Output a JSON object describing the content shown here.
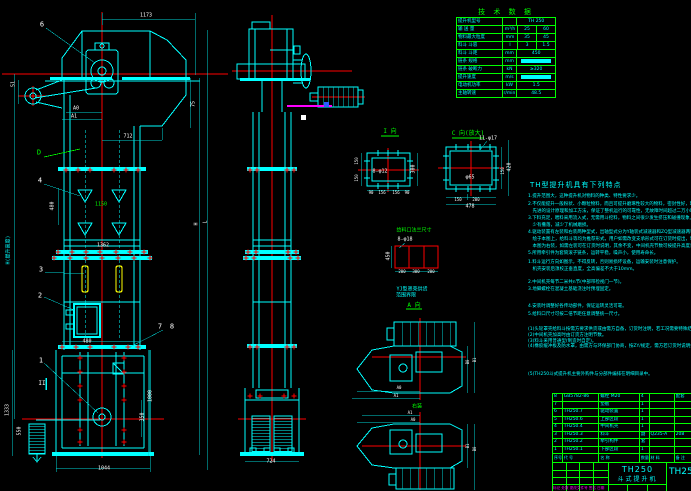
{
  "app": {
    "type": "cad-drawing",
    "background": "#000000"
  },
  "colors": {
    "geometry": "#00ffff",
    "centerline": "#ff0000",
    "table": "#00ff00",
    "dim_text": "#ffffff",
    "bucket": "#ffff00",
    "highlight": "#ff00ff",
    "grip": "#ffffff"
  },
  "tech_table": {
    "title": "技 术 数 据",
    "rows": [
      {
        "label": "提升机型号",
        "unit": "",
        "v1": "TH 250",
        "span": true
      },
      {
        "label": "输 送 量",
        "unit": "m³/h",
        "v1": "25",
        "v2": "60"
      },
      {
        "label": "物料最大粒度",
        "unit": "mm",
        "v1": "35",
        "v2": "45"
      },
      {
        "label": "料斗 斗容",
        "unit": "l",
        "v1": "3",
        "v2": "1.5"
      },
      {
        "label": "料斗 斗距",
        "unit": "mm",
        "v1": "450",
        "span": true
      },
      {
        "label": "链条 规格",
        "unit": "mm",
        "v1": "",
        "span": true,
        "filled": true
      },
      {
        "label": "链条 破断力",
        "unit": "kN",
        "v1": "≥320",
        "span": true
      },
      {
        "label": "提升速度",
        "unit": "m/s",
        "v1": "",
        "span": true,
        "filled": true
      },
      {
        "label": "电动机功率",
        "unit": "kW",
        "v1": "1.5",
        "span": true
      },
      {
        "label": "主轴转速",
        "unit": "r/min",
        "v1": "48.5",
        "span": true
      }
    ]
  },
  "notes": {
    "title": "TH型提升机具有下列特点",
    "lines": [
      {
        "y": 195,
        "t": "1.提升范围大，这种提升机对物料的种类、特性要求少。"
      },
      {
        "y": 203,
        "t": "2.不仅能提升一般粉状、小颗粒物料，而且可提升磨琢性较大的物料，密封性好，环境污染少，运行可靠性高，使用寿命长。"
      },
      {
        "y": 210,
        "t": "　先进的设计原理和加工方法，保证了整机运行的可靠性，无故障时间超过二万小时。"
      },
      {
        "y": 217,
        "t": "3.下料充足，喂料采用流入式，无需用斗挖料，物料之间很少发生挤压和碰撞现象，本机设计时保证物料在喂料、卸料时"
      },
      {
        "y": 224,
        "t": "　少有撒落，减少了机械磨损。"
      },
      {
        "y": 231,
        "t": "4.驱动装置有左装和右装两种型式，出轴型式分为Y轴装式减速器和ZQ型减速器两种，机上的驱动平台、栏杆、支架等均"
      },
      {
        "y": 238,
        "t": "　绘于本图上，给料斗等均为推荐形式，用户如需改变支承形式可在订货时提出，制造部门应满足用户要求。"
      },
      {
        "y": 245,
        "t": "　本图为右装，如需左装可在订货时说明，其余不变，中间机壳节数可按提升高度调整。"
      },
      {
        "y": 252,
        "t": "5.所用牵引件为套筒滚子链条，运转平稳，噪声小，使用寿命长。"
      },
      {
        "y": 261,
        "t": "1.料斗运行方向如图示，不得反转，否则易损坏设备，运输安装时注意保护。"
      },
      {
        "y": 268,
        "t": "　机壳安装后须校正垂直度，全高偏差不大于10mm。"
      },
      {
        "y": 281,
        "t": "2.中间机壳每节二米共n节(中部带检视门一节)。"
      },
      {
        "y": 288,
        "t": "3.地脚螺栓在混凝土基础浇注时预埋固定。"
      },
      {
        "y": 305,
        "t": "4.安装时调整好各传动部件，保证运转灵活可靠。"
      },
      {
        "y": 313,
        "t": "5.给料口尺寸可按二倍节距任意调整统一尺寸。"
      },
      {
        "y": 328,
        "t": "(1)头轮罩壳给料斗按需方要求供货或由需方自备，订货时注明，若工况需要特殊结构，由供需双方协商另行设计。"
      },
      {
        "y": 334,
        "t": "(2)中间机壳加高时由订货方注明节数。"
      },
      {
        "y": 340,
        "t": "(3)料斗采用普通型(制造时自定)。"
      },
      {
        "y": 345,
        "t": "(4)橡胶缓冲板及防水罩，由需方与环保部门协商，按ZY/规定，需方若订货时说明按协议生产供货。"
      },
      {
        "y": 373,
        "t": "(5)TH250斗式提升机主要外购件与分部件编排在明细目录中。"
      }
    ]
  },
  "bom": {
    "header": [
      "序号",
      "代  号",
      "名  称",
      "数量",
      "材  料",
      "备 注"
    ],
    "rows": [
      [
        "8",
        "GB5782-86",
        "螺栓 M20",
        "4",
        "",
        "配套"
      ],
      [
        "7",
        "",
        "垫板",
        "1",
        "",
        ""
      ],
      [
        "6",
        "TH250.7",
        "驱动装置",
        "1",
        "",
        ""
      ],
      [
        "5",
        "TH250.6",
        "上部区段",
        "1",
        "",
        ""
      ],
      [
        "4",
        "TH250.4",
        "中间机壳",
        "1",
        "",
        ""
      ],
      [
        "3",
        "TH250.3",
        "料斗",
        "副",
        "Q235-A",
        "208"
      ],
      [
        "2",
        "TH250.2",
        "牵引构件",
        "套",
        "",
        ""
      ],
      [
        "1",
        "TH250.1",
        "下部区段",
        "1",
        "",
        ""
      ]
    ]
  },
  "title_block": {
    "model": "TH250",
    "name": "斗式提升机",
    "drawing_no": "TH250",
    "revision_note": "标记 处数 更改文件号 签名 日期"
  },
  "labels": [
    {
      "t": "1173",
      "x": 146,
      "y": 16
    },
    {
      "t": "6",
      "x": 42,
      "y": 25,
      "s": 7,
      "n": "balloon-6"
    },
    {
      "t": "51",
      "x": 14,
      "y": 84,
      "r": 1
    },
    {
      "t": "75",
      "x": 194,
      "y": 104,
      "r": 1
    },
    {
      "t": "A0",
      "x": 76,
      "y": 109
    },
    {
      "t": "A1",
      "x": 74,
      "y": 117
    },
    {
      "t": "712",
      "x": 128,
      "y": 137
    },
    {
      "t": "D",
      "x": 39,
      "y": 153,
      "c": "g",
      "s": 7,
      "n": "detail-d-label"
    },
    {
      "t": "4",
      "x": 40,
      "y": 181,
      "s": 7,
      "n": "balloon-4"
    },
    {
      "t": "480",
      "x": 53,
      "y": 206,
      "r": 1
    },
    {
      "t": "1150",
      "x": 101,
      "y": 205,
      "c": "g"
    },
    {
      "t": "1362",
      "x": 103,
      "y": 246
    },
    {
      "t": "H(提升高度)",
      "x": 9,
      "y": 250,
      "r": 1,
      "c": "c",
      "n": "height-dim-label"
    },
    {
      "t": "3",
      "x": 41,
      "y": 270,
      "s": 7,
      "n": "balloon-3"
    },
    {
      "t": "2",
      "x": 40,
      "y": 296,
      "s": 7,
      "n": "balloon-2"
    },
    {
      "t": "H",
      "x": 197,
      "y": 224,
      "r": 1
    },
    {
      "t": "L",
      "x": 206,
      "y": 222,
      "r": 1
    },
    {
      "t": "7",
      "x": 160,
      "y": 327,
      "s": 7,
      "n": "balloon-7"
    },
    {
      "t": "8",
      "x": 172,
      "y": 327,
      "s": 7,
      "n": "balloon-8"
    },
    {
      "t": "480",
      "x": 87,
      "y": 342
    },
    {
      "t": "1",
      "x": 41,
      "y": 361,
      "s": 7,
      "n": "balloon-1"
    },
    {
      "t": "II",
      "x": 42,
      "y": 384,
      "s": 6
    },
    {
      "t": "1000",
      "x": 151,
      "y": 396,
      "r": 1
    },
    {
      "t": "350",
      "x": 143,
      "y": 417,
      "r": 1
    },
    {
      "t": "1333",
      "x": 8,
      "y": 410,
      "r": 1
    },
    {
      "t": "550",
      "x": 20,
      "y": 431,
      "r": 1
    },
    {
      "t": "1044",
      "x": 104,
      "y": 469
    },
    {
      "t": "724",
      "x": 271,
      "y": 462
    },
    {
      "t": "I 向",
      "x": 390,
      "y": 132,
      "c": "g",
      "s": 6,
      "n": "view-i-label"
    },
    {
      "t": "8-φ12",
      "x": 380,
      "y": 172
    },
    {
      "t": "150",
      "x": 357,
      "y": 161,
      "r": 1,
      "s": 4
    },
    {
      "t": "150",
      "x": 357,
      "y": 178,
      "r": 1,
      "s": 4
    },
    {
      "t": "300",
      "x": 414,
      "y": 169,
      "r": 1
    },
    {
      "t": "90",
      "x": 371,
      "y": 193,
      "s": 4
    },
    {
      "t": "156",
      "x": 382,
      "y": 193,
      "s": 4
    },
    {
      "t": "156",
      "x": 396,
      "y": 193,
      "s": 4
    },
    {
      "t": "90",
      "x": 407,
      "y": 193,
      "s": 4
    },
    {
      "t": "C 向(放大)",
      "x": 468,
      "y": 134,
      "c": "g",
      "s": 6,
      "n": "view-c-label"
    },
    {
      "t": "11-φ17",
      "x": 488,
      "y": 139
    },
    {
      "t": "φ65",
      "x": 470,
      "y": 178
    },
    {
      "t": "150",
      "x": 458,
      "y": 200,
      "s": 4
    },
    {
      "t": "200",
      "x": 476,
      "y": 200,
      "s": 4
    },
    {
      "t": "478",
      "x": 470,
      "y": 207
    },
    {
      "t": "150",
      "x": 503,
      "y": 171,
      "r": 1,
      "s": 4
    },
    {
      "t": "420",
      "x": 510,
      "y": 167,
      "r": 1
    },
    {
      "t": "给料口法兰尺寸",
      "x": 414,
      "y": 231,
      "c": "g",
      "n": "feed-flange-title"
    },
    {
      "t": "8-φ18",
      "x": 405,
      "y": 240
    },
    {
      "t": "450",
      "x": 389,
      "y": 256,
      "r": 1
    },
    {
      "t": "200",
      "x": 402,
      "y": 272,
      "s": 4
    },
    {
      "t": "300",
      "x": 416,
      "y": 272,
      "s": 4
    },
    {
      "t": "200",
      "x": 431,
      "y": 272,
      "s": 4
    },
    {
      "t": "YJ型罩壳供货",
      "x": 412,
      "y": 290,
      "c": "c",
      "n": "yj-note-line-1"
    },
    {
      "t": "范围界限",
      "x": 406,
      "y": 296,
      "c": "c",
      "n": "yj-note-line-2"
    },
    {
      "t": "A 向",
      "x": 414,
      "y": 306,
      "c": "g",
      "s": 6,
      "n": "view-a-label"
    },
    {
      "t": "B0",
      "x": 468,
      "y": 362,
      "r": 1,
      "s": 4
    },
    {
      "t": "B1",
      "x": 475,
      "y": 360,
      "r": 1,
      "s": 4
    },
    {
      "t": "A0",
      "x": 399,
      "y": 388,
      "s": 4
    },
    {
      "t": "A1",
      "x": 396,
      "y": 396,
      "s": 4
    },
    {
      "t": "右装",
      "x": 417,
      "y": 407,
      "c": "g",
      "n": "right-mount-label"
    },
    {
      "t": "A1",
      "x": 410,
      "y": 413,
      "s": 4
    },
    {
      "t": "A0",
      "x": 413,
      "y": 420,
      "s": 4
    },
    {
      "t": "B1",
      "x": 468,
      "y": 446,
      "r": 1,
      "s": 4
    },
    {
      "t": "B0",
      "x": 475,
      "y": 449,
      "r": 1,
      "s": 4
    }
  ]
}
